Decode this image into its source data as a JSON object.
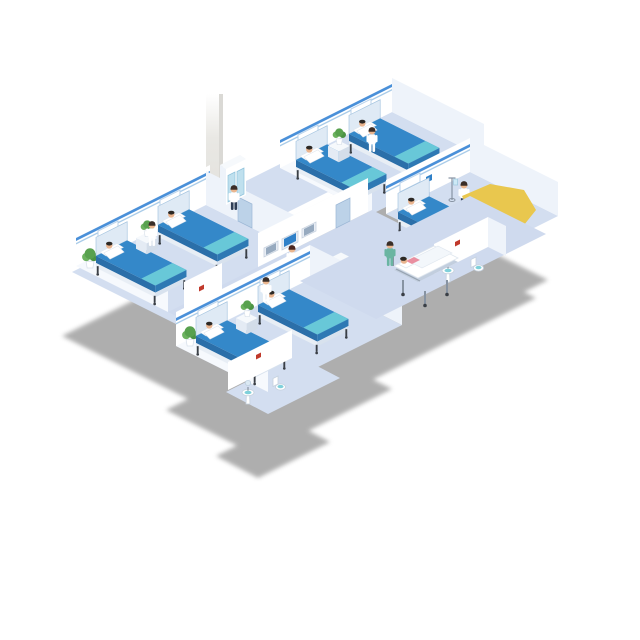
{
  "scene": {
    "description": "Isometric cutaway illustration of a hospital ward floor with patient rooms, a nurse station, self-service kiosks, bathrooms, medical staff and patients",
    "background_color": "#ffffff",
    "shadow_color": "#a8a8a8",
    "floor_color": "#d3def0",
    "wall_color": "#ffffff",
    "wall_trim_color": "#4a90d9",
    "bed_color": "#3488c9",
    "bed_foot_color": "#68c8d8",
    "accent_yellow": "#e9c74e",
    "scrubs_color": "#6ab5a2",
    "reception": {
      "desk_label": "护士站",
      "desk_color": "#2a5ea8",
      "monitor_count": 3
    },
    "rooms": [
      {
        "id": "ward-room-left",
        "beds": 2,
        "people": [
          "patient",
          "patient",
          "nurse"
        ]
      },
      {
        "id": "ward-room-top",
        "beds": 2,
        "people": [
          "patient",
          "patient",
          "nurse"
        ]
      },
      {
        "id": "ward-room-bottom",
        "beds": 2,
        "people": [
          "patient",
          "patient",
          "nurse"
        ]
      },
      {
        "id": "ward-room-right",
        "beds": 1,
        "people": [
          "patient",
          "doctor"
        ]
      }
    ],
    "bathrooms": [
      {
        "id": "bathroom-center",
        "fixtures": [
          "sink",
          "toilet"
        ]
      },
      {
        "id": "bathroom-bottom",
        "fixtures": [
          "sink",
          "toilet"
        ]
      },
      {
        "id": "bathroom-right",
        "fixtures": [
          "sink",
          "toilet"
        ]
      }
    ],
    "corridor": {
      "fixtures": [
        "nurse-station-desk",
        "wall-monitors",
        "medicine-cabinet",
        "self-service-kiosk",
        "self-service-kiosk",
        "stretcher",
        "iv-stand",
        "elevator-column"
      ],
      "people": [
        "receptionist",
        "pharmacist",
        "kiosk-user-orange",
        "kiosk-user-blue",
        "visitor",
        "visitor-with-briefcase",
        "nurse-walking",
        "nurse-pushing-stretcher",
        "stretcher-patient",
        "doctor"
      ]
    }
  }
}
